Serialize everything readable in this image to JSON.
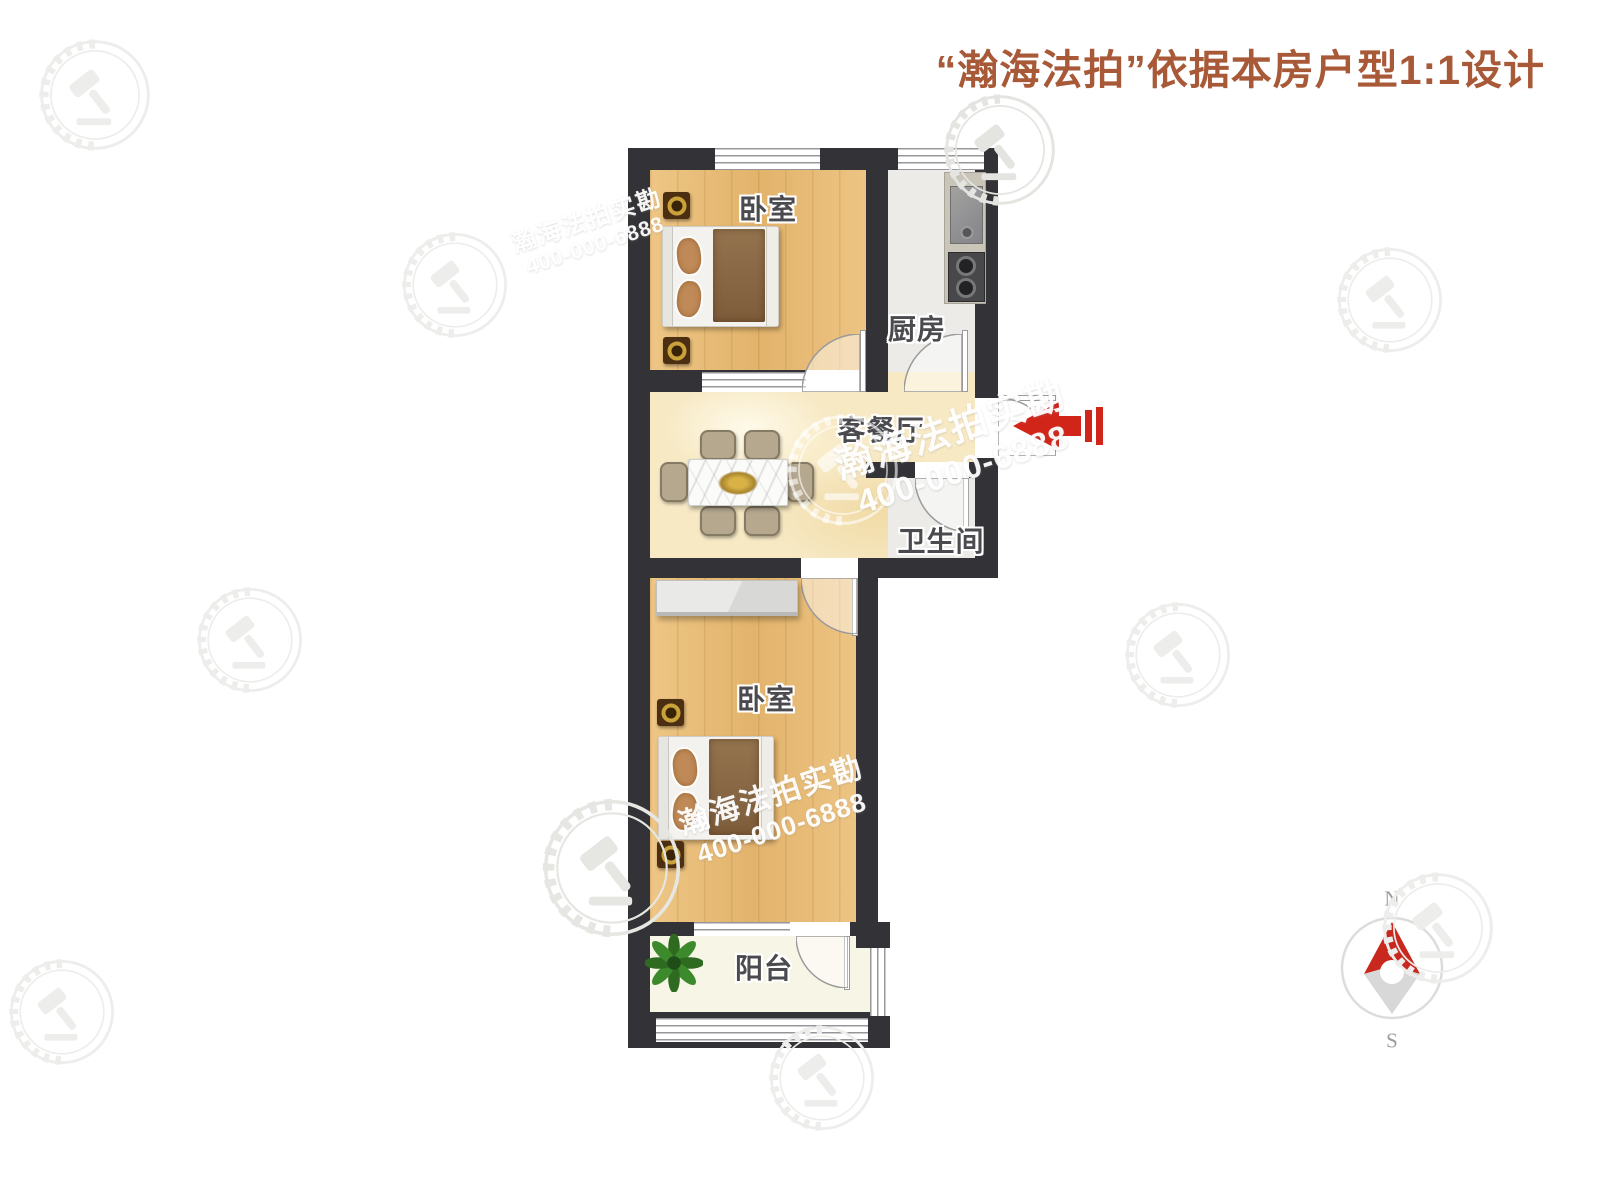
{
  "title": {
    "text": "“瀚海法拍”依据本房户型1:1设计"
  },
  "rooms": [
    {
      "id": "bedroom-top",
      "label": "卧室"
    },
    {
      "id": "kitchen",
      "label": "厨房"
    },
    {
      "id": "living-dining",
      "label": "客餐厅"
    },
    {
      "id": "bathroom",
      "label": "卫生间"
    },
    {
      "id": "bedroom-bottom",
      "label": "卧室"
    },
    {
      "id": "balcony",
      "label": "阳台"
    }
  ],
  "watermark": {
    "brand": "瀚海法拍实勘",
    "phone": "400-000-6888"
  },
  "compass": {
    "north": "N",
    "south": "S"
  },
  "colors": {
    "title": "#a85a38",
    "wall": "#333337",
    "wood_floor": "#eac17e",
    "living_floor": "#f7e9c4",
    "tile_floor": "#ecebe7",
    "balcony_floor": "#f7f5e5",
    "entry_arrow_red": "#d2251a",
    "compass_red": "#c8281e"
  }
}
